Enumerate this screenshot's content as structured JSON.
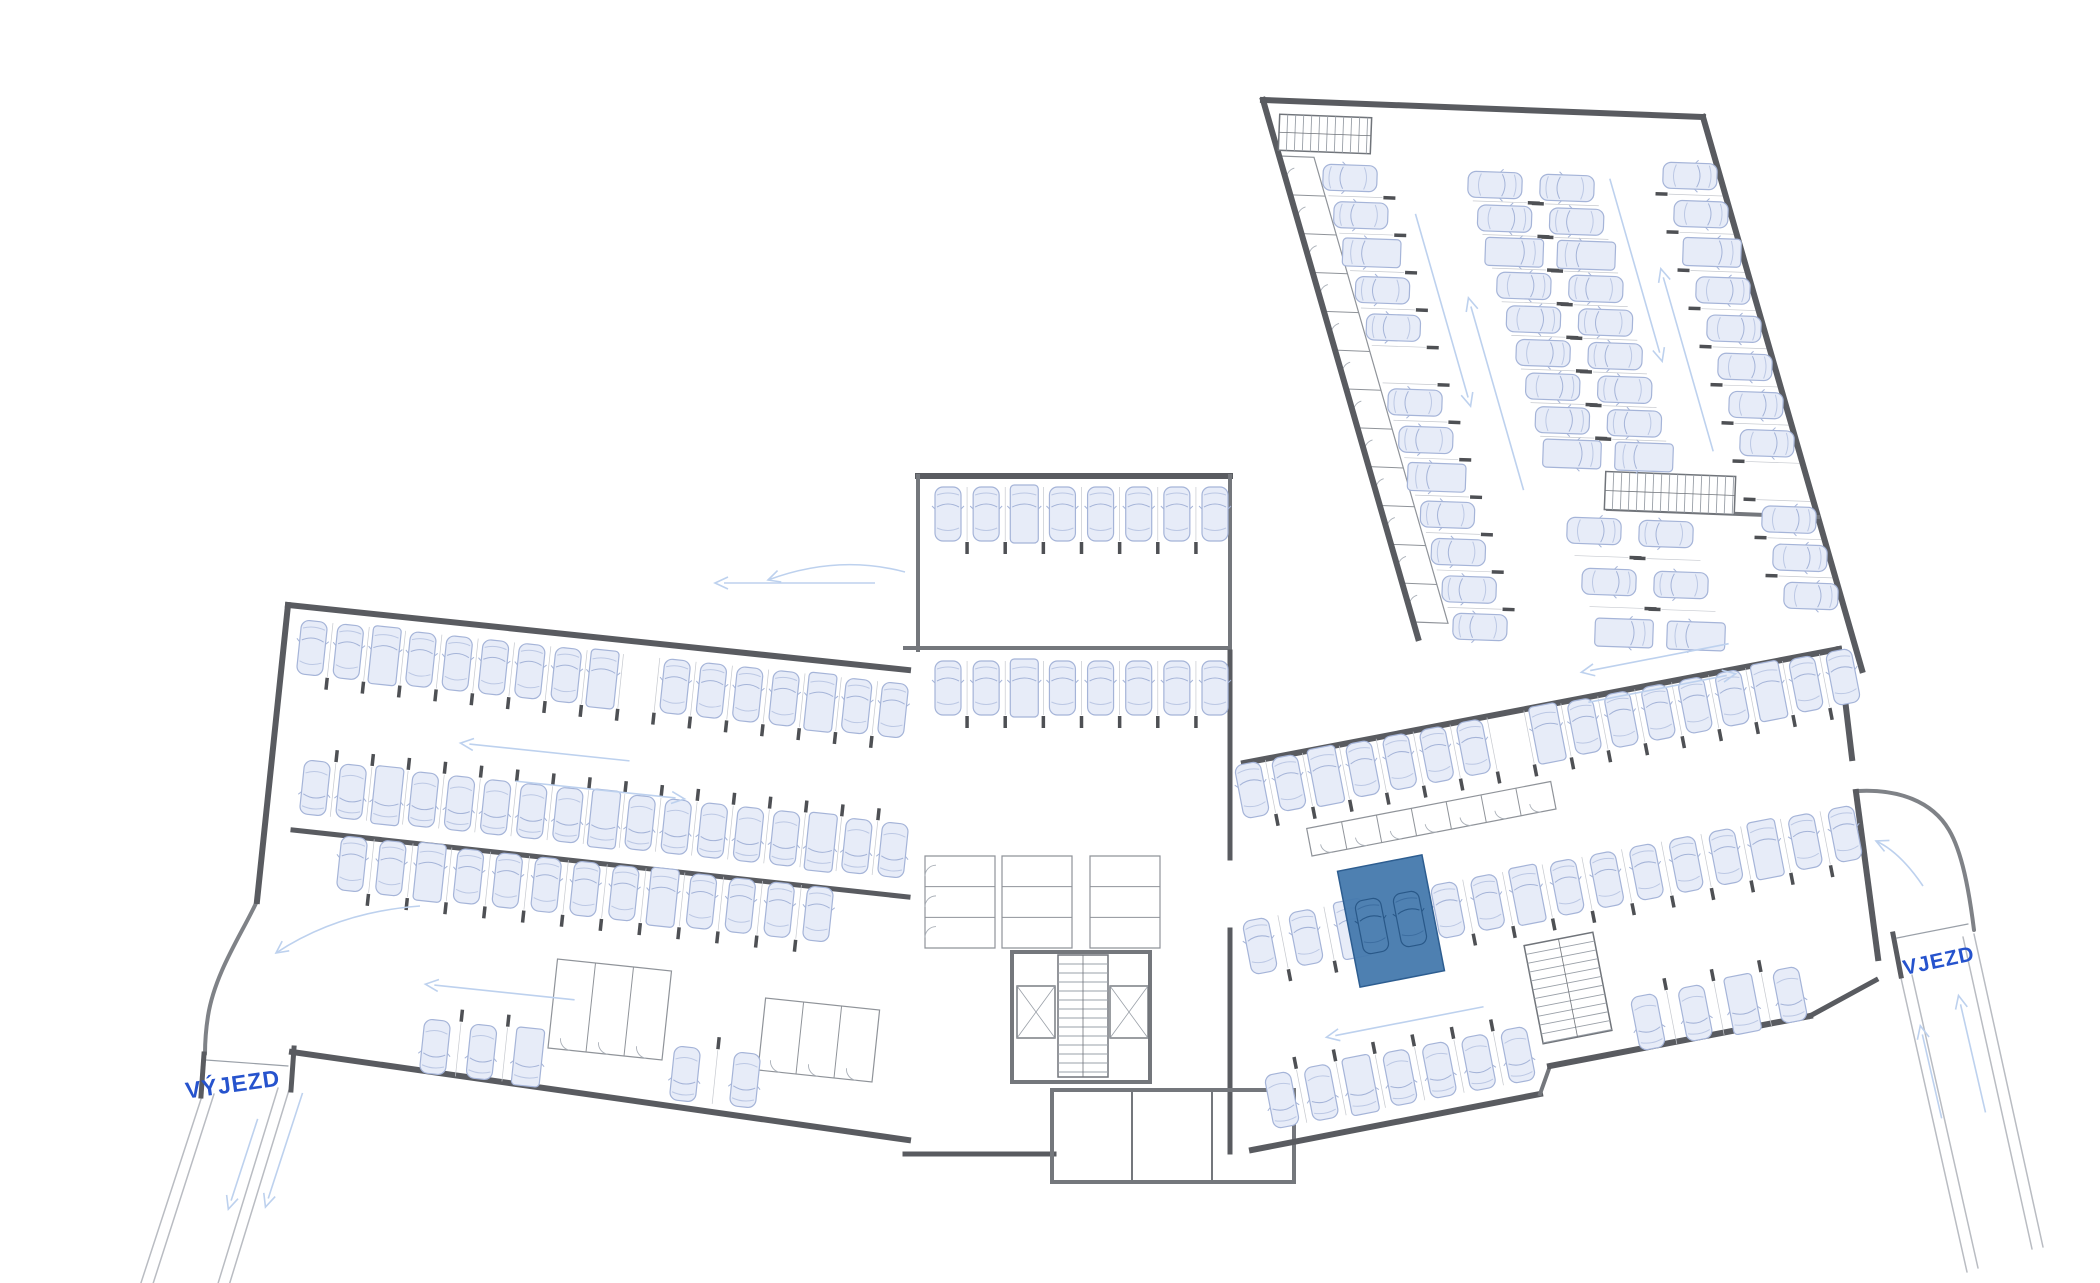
{
  "canvas": {
    "w": 2100,
    "h": 1283
  },
  "labels": {
    "exit": {
      "text": "VÝJEZD",
      "x": 233,
      "y": 1086,
      "rot": -8,
      "size": 23
    },
    "entrance": {
      "text": "VJEZD",
      "x": 1939,
      "y": 962,
      "rot": -12,
      "size": 21
    }
  },
  "colors": {
    "background": "#ffffff",
    "wall_dark": "#595b60",
    "wall_mid": "#74777c",
    "thin_line": "#c6c9cf",
    "cell_line": "#8f9399",
    "arc_line": "#aab0b8",
    "stair_line": "#9aa0a8",
    "stair_edge": "#70747a",
    "road_curb": "#7f8287",
    "road_edge": "#b9bcc2",
    "gate_line": "#9aa0a8",
    "car_fill": "#e7ecf8",
    "car_stroke": "#a5b4d8",
    "car_detail": "#bcc8e4",
    "tick": "#4e5054",
    "arrow": "#bdd1ee",
    "label": "#2653cd",
    "highlight_fill": "#4579ad",
    "highlight_stroke": "#2d5d90",
    "highlight_car_fill": "#4f81b2",
    "highlight_car_stroke": "#295888",
    "highlight_car_detail": "#3c6da0"
  },
  "highlight": {
    "cx": 1391,
    "cy": 921,
    "w": 86,
    "h": 118,
    "rot": -11,
    "cars": [
      [
        1372,
        926
      ],
      [
        1410,
        919
      ]
    ]
  },
  "walls": [
    [
      288,
      605,
      908,
      670,
      6
    ],
    [
      288,
      605,
      257,
      901,
      6
    ],
    [
      292,
      1052,
      908,
      1140,
      6
    ],
    [
      293,
      830,
      908,
      897,
      5
    ],
    [
      204,
      1054,
      201,
      1096,
      5
    ],
    [
      294,
      1048,
      291,
      1090,
      5
    ],
    [
      918,
      476,
      1230,
      476,
      6
    ],
    [
      918,
      476,
      918,
      650,
      4
    ],
    [
      1230,
      476,
      1230,
      652,
      4
    ],
    [
      905,
      648,
      1230,
      648,
      4
    ],
    [
      1230,
      652,
      1230,
      858,
      5
    ],
    [
      1230,
      930,
      1230,
      1152,
      5
    ],
    [
      905,
      1154,
      1054,
      1154,
      5
    ],
    [
      1012,
      952,
      1150,
      952,
      4
    ],
    [
      1012,
      952,
      1012,
      1082,
      4
    ],
    [
      1150,
      952,
      1150,
      1082,
      4
    ],
    [
      1012,
      1082,
      1150,
      1082,
      4
    ],
    [
      1052,
      1090,
      1294,
      1090,
      4
    ],
    [
      1052,
      1090,
      1052,
      1182,
      4
    ],
    [
      1294,
      1090,
      1294,
      1182,
      4
    ],
    [
      1052,
      1182,
      1294,
      1182,
      4
    ],
    [
      1132,
      1090,
      1132,
      1182,
      2
    ],
    [
      1212,
      1090,
      1212,
      1182,
      2
    ],
    [
      1244,
      763,
      1839,
      649,
      6
    ],
    [
      1839,
      649,
      1852,
      758,
      6
    ],
    [
      1856,
      792,
      1878,
      958,
      6
    ],
    [
      1252,
      1150,
      1540,
      1094,
      6
    ],
    [
      1540,
      1094,
      1550,
      1066,
      4
    ],
    [
      1550,
      1066,
      1810,
      1016,
      6
    ],
    [
      1810,
      1016,
      1876,
      980,
      5
    ],
    [
      1893,
      934,
      1901,
      976,
      5
    ],
    [
      1263,
      100,
      1703,
      117,
      6
    ],
    [
      1263,
      100,
      1418,
      638,
      6
    ],
    [
      1703,
      117,
      1862,
      670,
      6
    ],
    [
      1608,
      509,
      1818,
      517,
      4
    ]
  ],
  "car_rows": [
    {
      "name": "left-row-top",
      "p1": [
        312,
        648
      ],
      "p2": [
        893,
        710
      ],
      "n": 17,
      "rot": 6,
      "ticks": "tail",
      "skip": [
        9
      ]
    },
    {
      "name": "left-row-mid",
      "p1": [
        315,
        788
      ],
      "p2": [
        893,
        850
      ],
      "n": 17,
      "rot": 186,
      "ticks": "tail",
      "skip": []
    },
    {
      "name": "left-row-lower",
      "p1": [
        352,
        864
      ],
      "p2": [
        818,
        914
      ],
      "n": 13,
      "rot": 6,
      "ticks": "tail",
      "skip": []
    },
    {
      "name": "left-row-bottom-a",
      "p1": [
        435,
        1047
      ],
      "p2": [
        528,
        1057
      ],
      "n": 3,
      "rot": 186,
      "ticks": "tail",
      "skip": []
    },
    {
      "name": "left-row-bottom-b",
      "p1": [
        685,
        1074
      ],
      "p2": [
        745,
        1080
      ],
      "n": 2,
      "rot": 186,
      "ticks": "tail",
      "skip": []
    },
    {
      "name": "central-row-top",
      "p1": [
        948,
        514
      ],
      "p2": [
        1215,
        514
      ],
      "n": 8,
      "rot": 0,
      "ticks": "tail",
      "skip": []
    },
    {
      "name": "central-row-mid",
      "p1": [
        948,
        688
      ],
      "p2": [
        1215,
        688
      ],
      "n": 8,
      "rot": 0,
      "ticks": "tail",
      "skip": []
    },
    {
      "name": "right-row-top",
      "p1": [
        1252,
        790
      ],
      "p2": [
        1843,
        677
      ],
      "n": 17,
      "rot": -11,
      "ticks": "tail",
      "skip": [
        7
      ]
    },
    {
      "name": "right-row-mid-a",
      "p1": [
        1260,
        946
      ],
      "p2": [
        1352,
        929
      ],
      "n": 3,
      "rot": -11,
      "ticks": "tail",
      "skip": []
    },
    {
      "name": "right-row-mid-b",
      "p1": [
        1448,
        910
      ],
      "p2": [
        1845,
        834
      ],
      "n": 11,
      "rot": -11,
      "ticks": "tail",
      "skip": []
    },
    {
      "name": "right-row-bottom-a",
      "p1": [
        1282,
        1100
      ],
      "p2": [
        1518,
        1055
      ],
      "n": 7,
      "rot": 169,
      "ticks": "tail",
      "skip": []
    },
    {
      "name": "right-row-bottom-b",
      "p1": [
        1648,
        1022
      ],
      "p2": [
        1790,
        995
      ],
      "n": 4,
      "rot": 169,
      "ticks": "tail",
      "skip": []
    },
    {
      "name": "hall-col-left",
      "p1": [
        1350,
        178
      ],
      "p2": [
        1480,
        627
      ],
      "n": 13,
      "rot": -88,
      "ticks": "tail",
      "skip": [
        5
      ]
    },
    {
      "name": "hall-col-mid1-a",
      "p1": [
        1495,
        185
      ],
      "p2": [
        1572,
        454
      ],
      "n": 9,
      "rot": 92,
      "ticks": "nose",
      "skip": []
    },
    {
      "name": "hall-col-mid1-b",
      "p1": [
        1594,
        531
      ],
      "p2": [
        1624,
        633
      ],
      "n": 3,
      "rot": 92,
      "ticks": "nose",
      "skip": []
    },
    {
      "name": "hall-col-mid2-a",
      "p1": [
        1567,
        188
      ],
      "p2": [
        1644,
        457
      ],
      "n": 9,
      "rot": -88,
      "ticks": "nose",
      "skip": []
    },
    {
      "name": "hall-col-mid2-b",
      "p1": [
        1666,
        534
      ],
      "p2": [
        1696,
        636
      ],
      "n": 3,
      "rot": -88,
      "ticks": "nose",
      "skip": []
    },
    {
      "name": "hall-col-right",
      "p1": [
        1690,
        176
      ],
      "p2": [
        1811,
        596
      ],
      "n": 12,
      "rot": 92,
      "ticks": "tail",
      "skip": [
        8
      ]
    }
  ],
  "cells": [
    {
      "name": "hall-left-cellars",
      "p1": [
        1280,
        156
      ],
      "p2": [
        1414,
        622
      ],
      "d": [
        34,
        1.3
      ],
      "n": 12,
      "arcs": true
    },
    {
      "name": "right-wing-cellars",
      "p1": [
        1312,
        856
      ],
      "p2": [
        1556,
        809
      ],
      "d": [
        -5.3,
        -27.5
      ],
      "n": 7,
      "arcs": true
    },
    {
      "name": "left-wing-cellars-a",
      "p1": [
        548,
        1048
      ],
      "p2": [
        662,
        1060
      ],
      "d": [
        9.5,
        -89
      ],
      "n": 3,
      "arcs": true
    },
    {
      "name": "left-wing-cellars-b",
      "p1": [
        758,
        1070
      ],
      "p2": [
        872,
        1082
      ],
      "d": [
        7.6,
        -72
      ],
      "n": 3,
      "arcs": true
    },
    {
      "name": "central-cellars-left",
      "p1": [
        925,
        856
      ],
      "p2": [
        925,
        948
      ],
      "d": [
        70,
        0
      ],
      "n": 3,
      "arcs": true
    },
    {
      "name": "central-cellars-mid1",
      "p1": [
        1002,
        856
      ],
      "p2": [
        1002,
        948
      ],
      "d": [
        70,
        0
      ],
      "n": 3,
      "arcs": false
    },
    {
      "name": "central-cellars-mid2",
      "p1": [
        1160,
        856
      ],
      "p2": [
        1160,
        948
      ],
      "d": [
        -70,
        0
      ],
      "n": 3,
      "arcs": false
    }
  ],
  "stairs": [
    {
      "name": "hall-top-stair",
      "cx": 1325,
      "cy": 134,
      "w": 92,
      "h": 36,
      "rot": 2.2
    },
    {
      "name": "hall-bottom-stair",
      "cx": 1670,
      "cy": 493,
      "w": 130,
      "h": 38,
      "rot": 2.2
    },
    {
      "name": "right-wing-stair",
      "cx": 1568,
      "cy": 988,
      "w": 70,
      "h": 100,
      "rot": -11
    },
    {
      "name": "core-stair",
      "cx": 1083,
      "cy": 1016,
      "w": 50,
      "h": 122,
      "rot": 0
    }
  ],
  "elevators": [
    [
      1017,
      986,
      38,
      52
    ],
    [
      1110,
      986,
      38,
      52
    ]
  ],
  "arrows": [
    {
      "x": 545,
      "y": 752,
      "rot": -84,
      "len": 170
    },
    {
      "x": 600,
      "y": 790,
      "rot": 96,
      "len": 170
    },
    {
      "x": 500,
      "y": 992,
      "rot": -84,
      "len": 150
    },
    {
      "x": 795,
      "y": 583,
      "rot": -90,
      "len": 160
    },
    {
      "x": 1405,
      "y": 1022,
      "rot": -101,
      "len": 160
    },
    {
      "x": 1655,
      "y": 658,
      "rot": -101,
      "len": 150
    },
    {
      "x": 1662,
      "y": 688,
      "rot": 79,
      "len": 150
    },
    {
      "x": 1496,
      "y": 394,
      "rot": -16,
      "len": 200
    },
    {
      "x": 1443,
      "y": 310,
      "rot": 164,
      "len": 200
    },
    {
      "x": 1687,
      "y": 360,
      "rot": -16,
      "len": 190
    },
    {
      "x": 1636,
      "y": 270,
      "rot": 164,
      "len": 190
    },
    {
      "x": 243,
      "y": 1164,
      "rot": 198,
      "len": 95
    },
    {
      "x": 284,
      "y": 1150,
      "rot": 198,
      "len": 120
    },
    {
      "x": 1931,
      "y": 1072,
      "rot": -13,
      "len": 95
    },
    {
      "x": 1972,
      "y": 1054,
      "rot": -13,
      "len": 120
    }
  ],
  "curved_arrows": [
    {
      "d": "M905,572 Q838,554 768,580",
      "hx": 768,
      "hy": 580,
      "hrot": 252
    },
    {
      "d": "M1923,886 Q1900,852 1876,841",
      "hx": 1876,
      "hy": 841,
      "hrot": 294
    },
    {
      "d": "M420,906 Q338,912 276,953",
      "hx": 276,
      "hy": 953,
      "hrot": 234
    }
  ],
  "roads": [
    {
      "d": "M257,901 C243,932 215,972 208,1016 C205,1035 205,1046 205,1054",
      "style": "curb"
    },
    {
      "d": "M1858,791 C1898,789 1932,801 1949,830 C1962,852 1969,890 1974,930",
      "style": "curb"
    },
    {
      "d": "M206,1060 L288,1066",
      "style": "gate"
    },
    {
      "d": "M1897,938 L1968,924",
      "style": "gate"
    },
    {
      "d": "M202,1096 L138,1292",
      "style": "edge"
    },
    {
      "d": "M214,1094 L151,1290",
      "style": "edge"
    },
    {
      "d": "M289,1090 L227,1292",
      "style": "edge"
    },
    {
      "d": "M278,1088 L216,1290",
      "style": "edge"
    },
    {
      "d": "M1901,978 L1967,1272",
      "style": "edge"
    },
    {
      "d": "M1912,975 L1978,1268",
      "style": "edge"
    },
    {
      "d": "M1974,934 L2043,1247",
      "style": "edge"
    },
    {
      "d": "M1963,937 L2032,1249",
      "style": "edge"
    }
  ]
}
